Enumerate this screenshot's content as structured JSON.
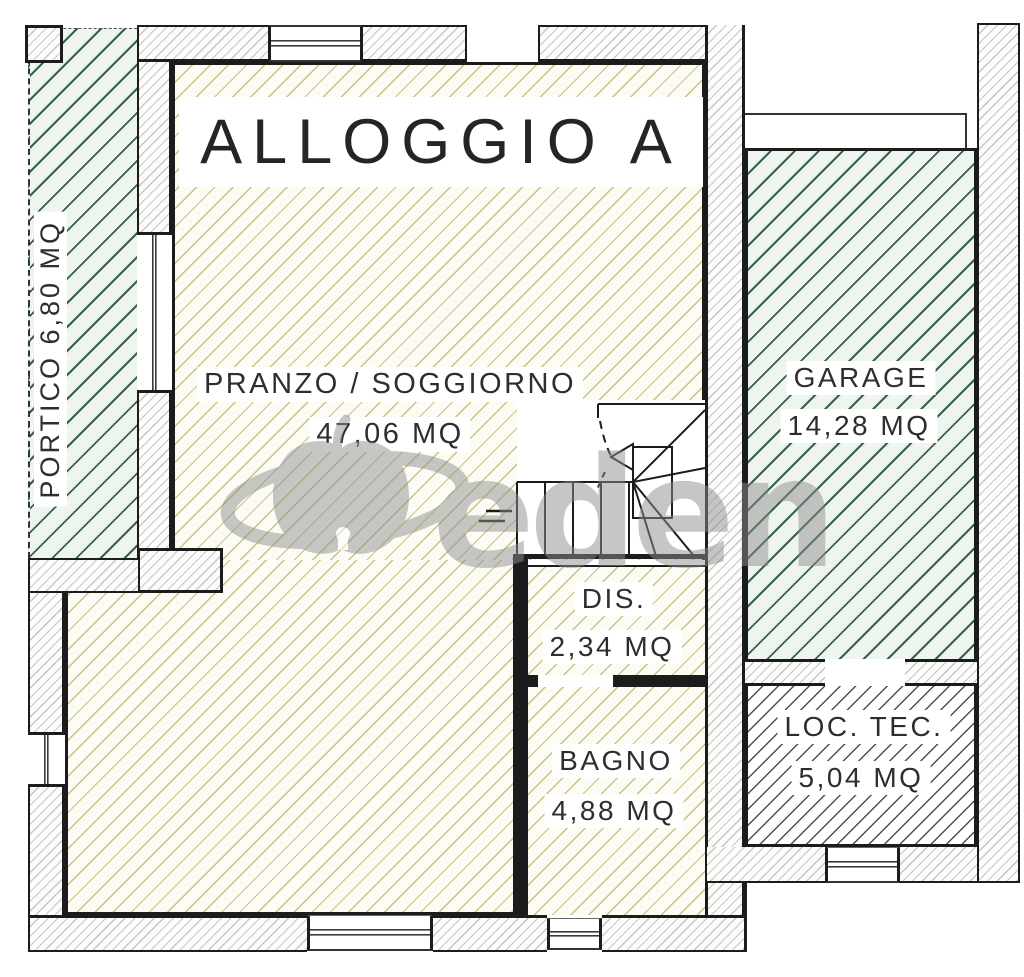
{
  "title": "ALLOGGIO A",
  "watermark": {
    "text": "eden"
  },
  "rooms": {
    "portico": {
      "label": "PORTICO  6,80 MQ"
    },
    "pranzo": {
      "name": "PRANZO / SOGGIORNO",
      "area": "47,06 MQ"
    },
    "dis": {
      "name": "DIS.",
      "area": "2,34 MQ"
    },
    "bagno": {
      "name": "BAGNO",
      "area": "4,88 MQ"
    },
    "garage": {
      "name": "GARAGE",
      "area": "14,28 MQ"
    },
    "loctec": {
      "name": "LOC. TEC.",
      "area": "5,04 MQ"
    }
  },
  "colors": {
    "hatch_green": "#36604a",
    "hatch_yellow": "#c9c087",
    "wall_gray": "#b5b3ae",
    "dark_hatch": "#4f4f4f",
    "line": "#1c1c1c",
    "watermark_gray": "#8f8f8f"
  }
}
